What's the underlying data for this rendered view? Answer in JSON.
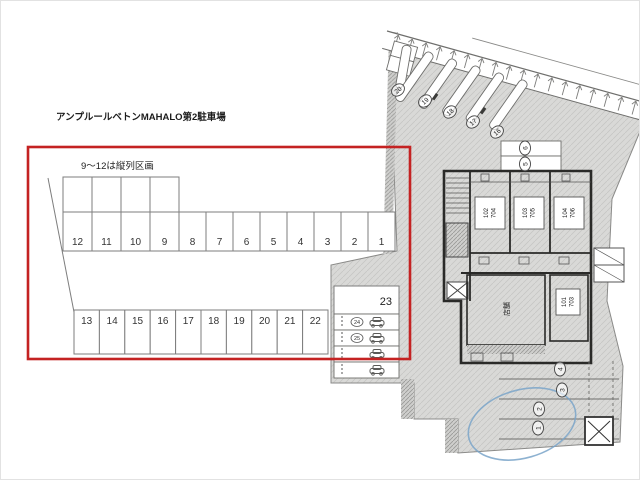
{
  "title": "アンプルールベトンMAHALO第2駐車場",
  "lot": {
    "note": "9〜12は縦列区画",
    "top_row": [
      "12",
      "11",
      "10",
      "9",
      "8",
      "7",
      "6",
      "5",
      "4",
      "3",
      "2",
      "1"
    ],
    "bottom_row": [
      "13",
      "14",
      "15",
      "16",
      "17",
      "18",
      "19",
      "20",
      "21",
      "22"
    ],
    "large_space": "23",
    "small_spaces": [
      "24",
      "25"
    ],
    "highlight_color": "#c42222"
  },
  "site_plan": {
    "rooms": [
      {
        "line1": "102",
        "line2": "704"
      },
      {
        "line1": "103",
        "line2": "705"
      },
      {
        "line1": "104",
        "line2": "706"
      },
      {
        "line1": "101",
        "line2": "703"
      }
    ],
    "shop_label": "店舗",
    "road_spots": [
      "20",
      "19",
      "18",
      "17",
      "16"
    ],
    "upper_spots": [
      "6",
      "5"
    ],
    "right_spots": [
      "4",
      "3",
      "2",
      "1"
    ],
    "pen_color": "#7aa4c9"
  }
}
